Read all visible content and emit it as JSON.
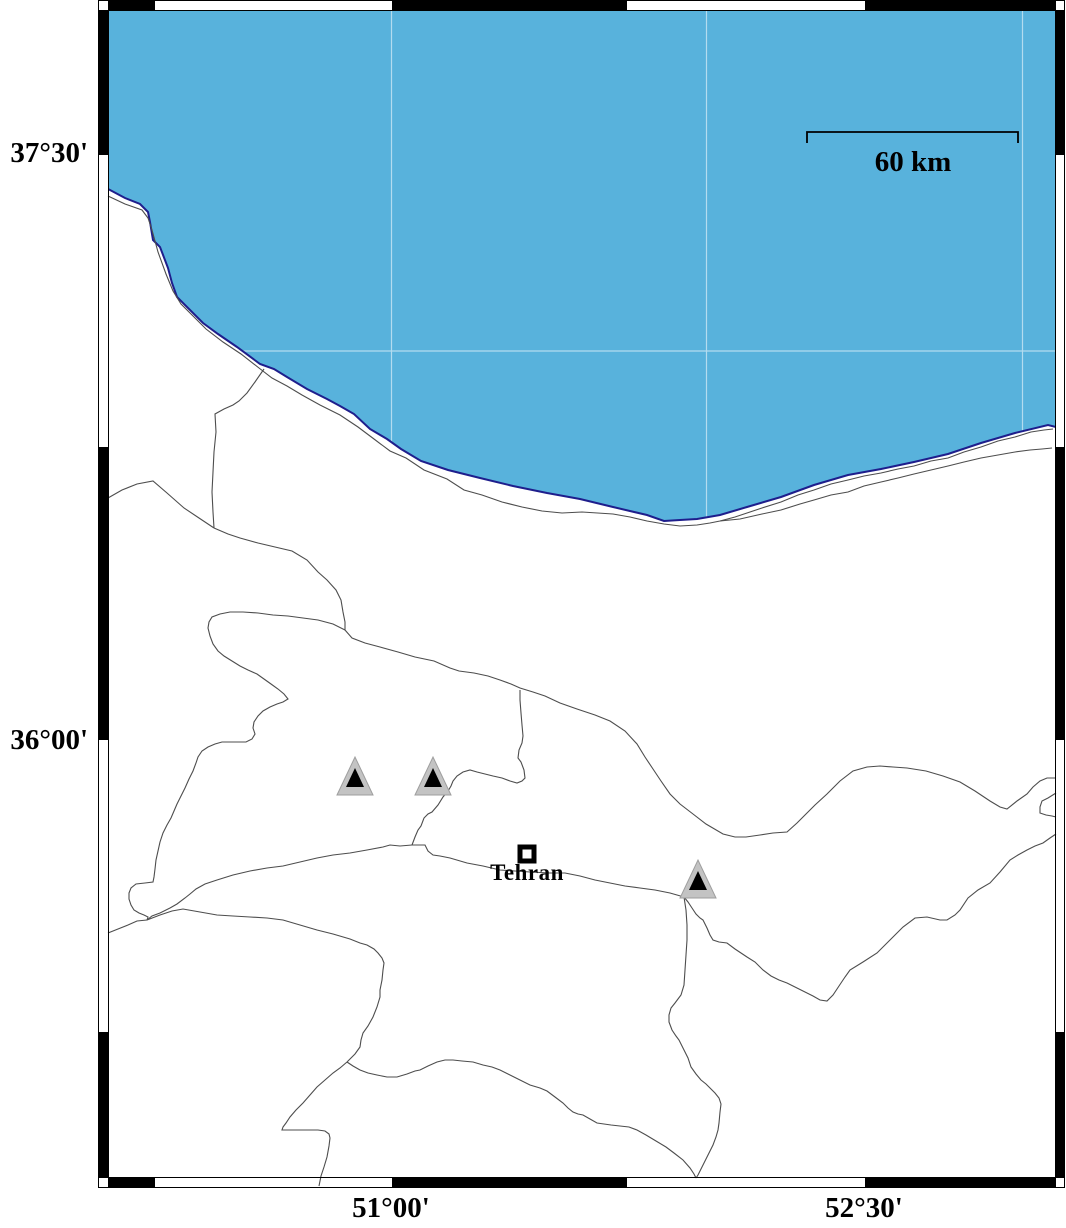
{
  "map": {
    "axis": {
      "y_labels": [
        {
          "text": "37°30'",
          "x": 88,
          "y": 155
        },
        {
          "text": "36°00'",
          "x": 88,
          "y": 742
        }
      ],
      "x_labels": [
        {
          "text": "51°00'",
          "x": 391,
          "y": 1192
        },
        {
          "text": "52°30'",
          "x": 864,
          "y": 1192
        }
      ]
    },
    "scale_bar": {
      "label": "60 km",
      "x1": 807,
      "x2": 1018,
      "y": 132,
      "tick_drop": 11,
      "label_x": 913,
      "label_y": 146
    },
    "city": {
      "label": "Tehran",
      "x": 527,
      "y": 854,
      "label_y": 860
    },
    "volcano_markers": [
      {
        "x": 355,
        "y": 781
      },
      {
        "x": 433,
        "y": 781
      },
      {
        "x": 698,
        "y": 884
      }
    ],
    "colors": {
      "sea": "#58b2dc",
      "coastline": "#1e1e8c",
      "border_line": "#4d4d4d",
      "grid": "#ffffff",
      "frame": "#000000",
      "marker_fill": "#c3c3c3",
      "marker_edge": "#9e9e9e",
      "marker_inner": "#000000"
    }
  }
}
